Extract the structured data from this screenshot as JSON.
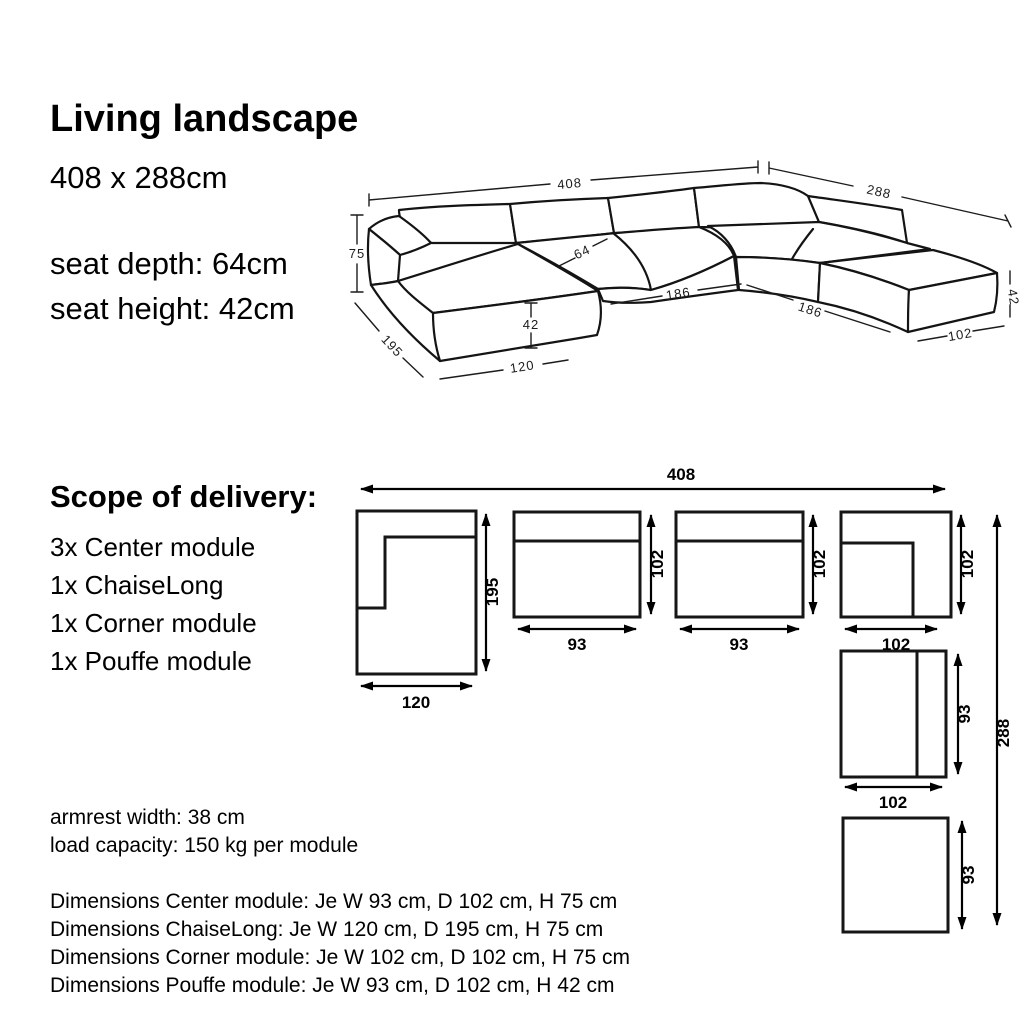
{
  "header": {
    "title": "Living landscape",
    "size": "408 x 288cm",
    "seat_depth": "seat depth: 64cm",
    "seat_height": "seat height: 42cm"
  },
  "perspective": {
    "total_width": "408",
    "total_depth": "288",
    "back_height": "75",
    "seat_surface_depth": "64",
    "seat_height": "42",
    "inner_width": "186",
    "inner_depth": "186",
    "chaise_depth": "195",
    "chaise_width": "120",
    "pouffe_height": "42",
    "pouffe_width": "102"
  },
  "scope": {
    "title": "Scope of delivery:",
    "items": [
      "3x Center module",
      "1x ChaiseLong",
      "1x Corner module",
      "1x Pouffe module"
    ]
  },
  "plan": {
    "total_width": "408",
    "total_depth": "288",
    "chaise_depth": "195",
    "chaise_width": "120",
    "center1_depth": "102",
    "center1_width": "93",
    "center2_depth": "102",
    "center2_width": "93",
    "corner_depth": "102",
    "corner_width": "102",
    "center3_side": "93",
    "center3_width": "102",
    "pouffe_side": "93"
  },
  "notes": {
    "armrest": "armrest width: 38 cm",
    "load": "load capacity: 150 kg per module",
    "dim_center": "Dimensions Center module: Je W 93 cm, D 102 cm, H 75 cm",
    "dim_chaise": "Dimensions ChaiseLong: Je W 120 cm, D 195 cm, H 75 cm",
    "dim_corner": "Dimensions Corner module: Je W 102 cm, D 102 cm, H 75 cm",
    "dim_pouffe": "Dimensions Pouffe module: Je W 93 cm, D 102 cm, H 42 cm"
  }
}
